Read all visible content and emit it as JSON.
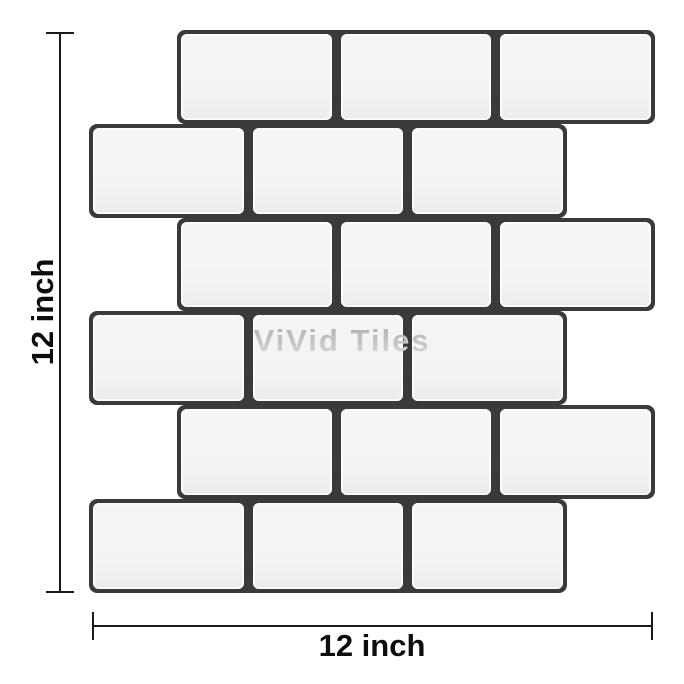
{
  "figure": {
    "watermark": "ViVid Tiles",
    "dimensions": {
      "height_label": "12 inch",
      "width_label": "12 inch"
    },
    "tile_panel": {
      "rows": 6,
      "tiles_per_row": 3,
      "pattern": "offset-brick-subway",
      "tile_color": "#f2f3f2",
      "grout_color": "#3a3a3a"
    },
    "colors": {
      "background": "#ffffff",
      "dimension_line": "#1b1b1b",
      "label_text": "#0d0d0d",
      "watermark_text": "#c3c3c3"
    }
  }
}
